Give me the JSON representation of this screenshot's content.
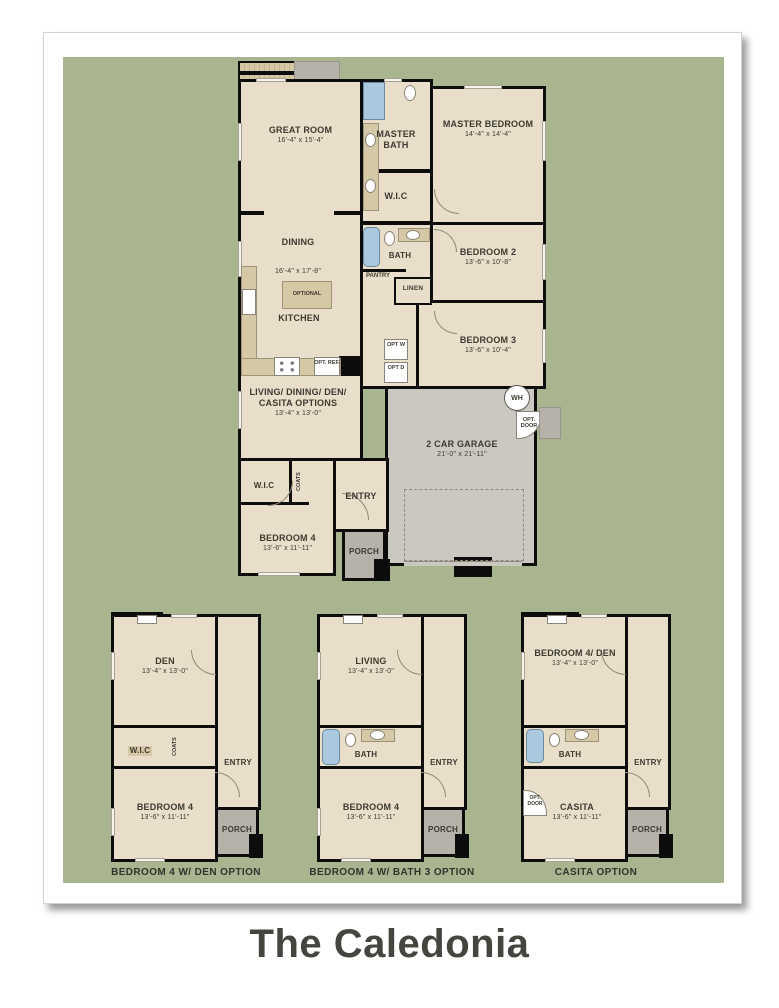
{
  "title": "The Caledonia",
  "colors": {
    "canvas": "#a9b58f",
    "room": "#e8dec9",
    "counter": "#d5c8a5",
    "garage": "#cbc8c1",
    "porch": "#b6b1a9",
    "wall": "#0d0d0d",
    "blue": "#abc9de",
    "ink": "#3e3a31"
  },
  "main": {
    "great_room": {
      "name": "GREAT ROOM",
      "dims": "16'-4\" x 15'-4\""
    },
    "master_bath": {
      "name": "MASTER BATH"
    },
    "master_bedroom": {
      "name": "MASTER BEDROOM",
      "dims": "14'-4\" x 14'-4\""
    },
    "master_wic": {
      "name": "W.I.C"
    },
    "dining": {
      "name": "DINING",
      "dims": "16'-4\" x 17'-8\""
    },
    "bath": {
      "name": "BATH"
    },
    "bedroom2": {
      "name": "BEDROOM 2",
      "dims": "13'-6\" x 10'-8\""
    },
    "pantry": {
      "name": "PANTRY"
    },
    "linen": {
      "name": "LINEN"
    },
    "kitchen": {
      "name": "KITCHEN"
    },
    "optional_island": {
      "name": "OPTIONAL"
    },
    "opt_ref": {
      "name": "OPT. REF."
    },
    "bedroom3": {
      "name": "BEDROOM 3",
      "dims": "13'-6\" x 10'-4\""
    },
    "opt_washer": {
      "name": "OPT W"
    },
    "opt_dryer": {
      "name": "OPT D"
    },
    "flex_room": {
      "name": "LIVING/ DINING/ DEN/ CASITA OPTIONS",
      "dims": "13'-4\" x 13'-0\""
    },
    "water_heater": {
      "name": "WH"
    },
    "opt_door": {
      "name": "OPT. DOOR"
    },
    "garage": {
      "name": "2 CAR GARAGE",
      "dims": "21'-0\" x 21'-11\""
    },
    "wic4": {
      "name": "W.I.C"
    },
    "coats": {
      "name": "COATS"
    },
    "entry": {
      "name": "ENTRY"
    },
    "bedroom4": {
      "name": "BEDROOM 4",
      "dims": "13'-6\" x 11'-11\""
    },
    "porch": {
      "name": "PORCH"
    }
  },
  "options": [
    {
      "caption": "BEDROOM 4 W/ DEN OPTION",
      "top_room": {
        "name": "DEN",
        "dims": "13'-4\" x 13'-0\""
      },
      "wic": {
        "name": "W.I.C"
      },
      "coats": {
        "name": "COATS"
      },
      "entry": "ENTRY",
      "bottom_room": {
        "name": "BEDROOM 4",
        "dims": "13'-6\" x 11'-11\""
      },
      "porch": "PORCH"
    },
    {
      "caption": "BEDROOM 4 W/ BATH 3 OPTION",
      "top_room": {
        "name": "LIVING",
        "dims": "13'-4\" x 13'-0\""
      },
      "bath": "BATH",
      "entry": "ENTRY",
      "bottom_room": {
        "name": "BEDROOM 4",
        "dims": "13'-6\" x 11'-11\""
      },
      "porch": "PORCH"
    },
    {
      "caption": "CASITA OPTION",
      "top_room": {
        "name": "BEDROOM 4/ DEN",
        "dims": "13'-4\" x 13'-0\""
      },
      "bath": "BATH",
      "opt_door": "OPT. DOOR",
      "entry": "ENTRY",
      "bottom_room": {
        "name": "CASITA",
        "dims": "13'-6\" x 11'-11\""
      },
      "porch": "PORCH"
    }
  ]
}
